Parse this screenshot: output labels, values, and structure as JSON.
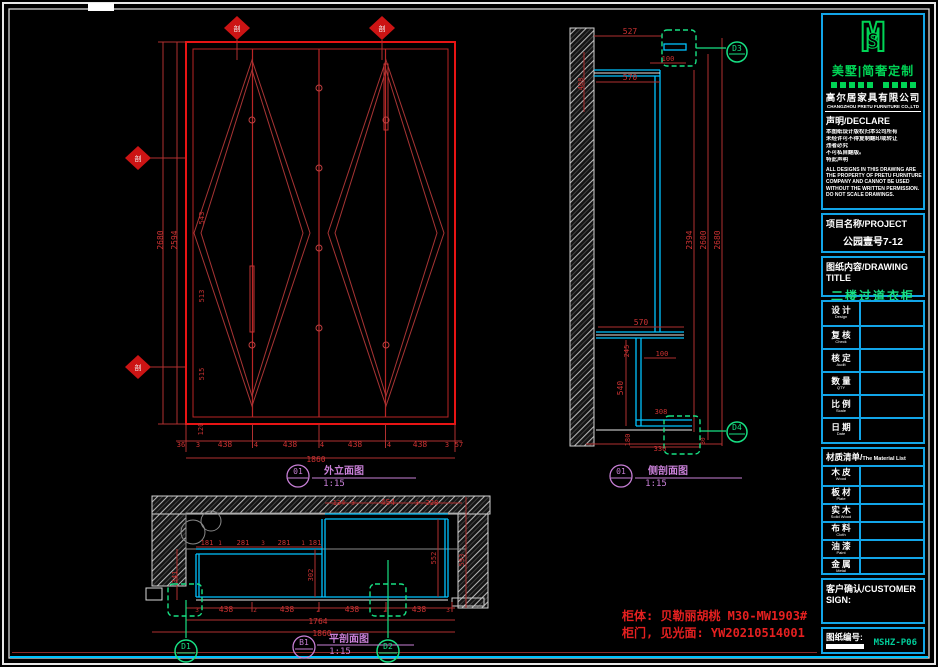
{
  "colors": {
    "dim": "#cd3232",
    "bright": "#e52020",
    "mag": "#c77fd6",
    "grn": "#17e083",
    "wht": "#f2f2f2",
    "cyn": "#00c3ff"
  },
  "title_block": {
    "logo": {
      "m": "M",
      "s": "S",
      "brand": "美墅|简奢定制"
    },
    "company": {
      "zh": "高尔居家具有限公司",
      "en": "CHANGZHOU PRETU FURNITURE CO.,LTD"
    },
    "declare": {
      "header": "声明/DECLARE",
      "zh_lines": [
        "本图纸设计版权归本公司所有",
        "未经许可不得复制翻印或转让",
        "违者必究",
        "不可私自翻版。",
        "特此声明"
      ],
      "en_lines": [
        "ALL DESIGNS IN THIS DRAWING ARE",
        "THE PROPERTY OF PRETU FURNITURE",
        "COMPANY AND CANNOT BE USED",
        "WITHOUT THE WRITTEN PERMISSION.",
        "DO NOT SCALE DRAWINGS."
      ]
    },
    "project": {
      "header": "项目名称/PROJECT",
      "value": "公园壹号7-12"
    },
    "drawing_title": {
      "header": "图纸内容/DRAWING TITLE",
      "value": "二楼过道衣柜"
    },
    "info_table": {
      "rows": [
        {
          "zh": "设  计",
          "en": "Design"
        },
        {
          "zh": "复  核",
          "en": "Check"
        },
        {
          "zh": "核  定",
          "en": "Audit"
        },
        {
          "zh": "数  量",
          "en": "QTY"
        },
        {
          "zh": "比  例",
          "en": "Scale"
        },
        {
          "zh": "日  期",
          "en": "Date"
        }
      ]
    },
    "material_list": {
      "header_zh": "材质清单/",
      "header_en": "The Material List",
      "rows": [
        {
          "zh": "木  皮",
          "en": "Wood"
        },
        {
          "zh": "板  材",
          "en": "Plate"
        },
        {
          "zh": "实  木",
          "en": "Solid Wood"
        },
        {
          "zh": "布  料",
          "en": "Cloth"
        },
        {
          "zh": "油  漆",
          "en": "Paint"
        },
        {
          "zh": "金  属",
          "en": "Metal"
        }
      ]
    },
    "customer": {
      "header": "客户确认/CUSTOMER SIGN:"
    },
    "drawing_no": {
      "label": "图纸编号:",
      "value": "MSHZ-P06"
    }
  },
  "drawing": {
    "texts": [
      {
        "t": "2680",
        "x": 163,
        "y": 240,
        "r": -90,
        "n": "dim-fe-height"
      },
      {
        "t": "2594",
        "x": 177,
        "y": 240,
        "r": -90,
        "n": "dim-fe-height"
      },
      {
        "t": "543",
        "x": 204,
        "y": 218,
        "r": -90,
        "s": 7
      },
      {
        "t": "513",
        "x": 204,
        "y": 296,
        "r": -90,
        "s": 7
      },
      {
        "t": "515",
        "x": 204,
        "y": 374,
        "r": -90,
        "s": 7
      },
      {
        "t": "120",
        "x": 203,
        "y": 429,
        "r": -90,
        "s": 7
      },
      {
        "t": "36",
        "x": 181,
        "y": 447,
        "s": 7
      },
      {
        "t": "3",
        "x": 198,
        "y": 447,
        "s": 7
      },
      {
        "t": "438",
        "x": 225,
        "y": 447
      },
      {
        "t": "4",
        "x": 256,
        "y": 447,
        "s": 7
      },
      {
        "t": "438",
        "x": 290,
        "y": 447
      },
      {
        "t": "4",
        "x": 322,
        "y": 447,
        "s": 7
      },
      {
        "t": "438",
        "x": 355,
        "y": 447
      },
      {
        "t": "4",
        "x": 389,
        "y": 447,
        "s": 7
      },
      {
        "t": "438",
        "x": 420,
        "y": 447
      },
      {
        "t": "3",
        "x": 447,
        "y": 447,
        "s": 7
      },
      {
        "t": "57",
        "x": 459,
        "y": 447,
        "s": 7
      },
      {
        "t": "1860",
        "x": 316,
        "y": 462,
        "n": "dim-fe-total"
      },
      {
        "t": "01",
        "x": 298,
        "y": 474,
        "c": "mag",
        "n": "view-bubble"
      },
      {
        "t": "外立面图",
        "x": 344,
        "y": 474,
        "c": "mag",
        "s": 10,
        "b": 1,
        "n": "view-title",
        "f": 1
      },
      {
        "t": "1:15",
        "x": 334,
        "y": 486,
        "c": "mag",
        "s": 9,
        "n": "view-scale"
      },
      {
        "t": "剖",
        "x": 237,
        "y": 31,
        "c": "wht",
        "s": 7,
        "n": "section-marker-label",
        "f": 1
      },
      {
        "t": "剖",
        "x": 382,
        "y": 31,
        "c": "wht",
        "s": 7,
        "n": "section-marker-label",
        "f": 1
      },
      {
        "t": "剖",
        "x": 138,
        "y": 161,
        "c": "wht",
        "s": 7,
        "n": "section-marker-label",
        "f": 1
      },
      {
        "t": "剖",
        "x": 138,
        "y": 370,
        "c": "wht",
        "s": 7,
        "n": "section-marker-label",
        "f": 1
      },
      {
        "t": "527",
        "x": 630,
        "y": 34
      },
      {
        "t": "100",
        "x": 668,
        "y": 61,
        "s": 7
      },
      {
        "t": "570",
        "x": 630,
        "y": 80
      },
      {
        "t": "408",
        "x": 583,
        "y": 84,
        "r": -90,
        "s": 7
      },
      {
        "t": "2394",
        "x": 692,
        "y": 240,
        "r": -90
      },
      {
        "t": "2600",
        "x": 706,
        "y": 240,
        "r": -90
      },
      {
        "t": "2680",
        "x": 720,
        "y": 240,
        "r": -90
      },
      {
        "t": "570",
        "x": 641,
        "y": 325
      },
      {
        "t": "245",
        "x": 629,
        "y": 351,
        "r": -90,
        "s": 7
      },
      {
        "t": "100",
        "x": 662,
        "y": 356,
        "s": 7
      },
      {
        "t": "540",
        "x": 623,
        "y": 388,
        "r": -90
      },
      {
        "t": "308",
        "x": 661,
        "y": 414,
        "s": 7
      },
      {
        "t": "180",
        "x": 630,
        "y": 440,
        "r": -90,
        "s": 7
      },
      {
        "t": "330",
        "x": 660,
        "y": 451,
        "s": 7
      },
      {
        "t": "30",
        "x": 705,
        "y": 441,
        "r": -90,
        "s": 6
      },
      {
        "t": "D3",
        "x": 737,
        "y": 51,
        "c": "grn",
        "n": "detail-bubble"
      },
      {
        "t": "D4",
        "x": 737,
        "y": 430,
        "c": "grn",
        "n": "detail-bubble"
      },
      {
        "t": "01",
        "x": 621,
        "y": 474,
        "c": "mag",
        "n": "view-bubble"
      },
      {
        "t": "侧剖面图",
        "x": 668,
        "y": 474,
        "c": "mag",
        "s": 10,
        "b": 1,
        "n": "view-title",
        "f": 1
      },
      {
        "t": "1:15",
        "x": 656,
        "y": 486,
        "c": "mag",
        "s": 9,
        "n": "view-scale"
      },
      {
        "t": "134",
        "x": 339,
        "y": 505,
        "s": 7
      },
      {
        "t": "3",
        "x": 353,
        "y": 505,
        "s": 6
      },
      {
        "t": "454",
        "x": 388,
        "y": 505
      },
      {
        "t": "3",
        "x": 417,
        "y": 505,
        "s": 6
      },
      {
        "t": "228",
        "x": 432,
        "y": 505,
        "s": 7
      },
      {
        "t": "181",
        "x": 207,
        "y": 545,
        "s": 7
      },
      {
        "t": "1",
        "x": 220,
        "y": 545,
        "s": 6
      },
      {
        "t": "281",
        "x": 243,
        "y": 545,
        "s": 7
      },
      {
        "t": "3",
        "x": 263,
        "y": 545,
        "s": 6
      },
      {
        "t": "281",
        "x": 284,
        "y": 545,
        "s": 7
      },
      {
        "t": "1",
        "x": 303,
        "y": 545,
        "s": 6
      },
      {
        "t": "181",
        "x": 315,
        "y": 545,
        "s": 7
      },
      {
        "t": "341",
        "x": 177,
        "y": 577,
        "r": -90,
        "s": 7
      },
      {
        "t": "302",
        "x": 313,
        "y": 575,
        "r": -90,
        "s": 7
      },
      {
        "t": "552",
        "x": 436,
        "y": 558,
        "r": -90,
        "s": 7
      },
      {
        "t": "593",
        "x": 464,
        "y": 560,
        "r": -90,
        "s": 7
      },
      {
        "t": "3",
        "x": 197,
        "y": 612,
        "s": 6
      },
      {
        "t": "438",
        "x": 226,
        "y": 612
      },
      {
        "t": "2",
        "x": 255,
        "y": 612,
        "s": 6
      },
      {
        "t": "438",
        "x": 287,
        "y": 612
      },
      {
        "t": "2",
        "x": 318,
        "y": 612,
        "s": 6
      },
      {
        "t": "438",
        "x": 352,
        "y": 612
      },
      {
        "t": "2",
        "x": 385,
        "y": 612,
        "s": 6
      },
      {
        "t": "438",
        "x": 419,
        "y": 612
      },
      {
        "t": "3",
        "x": 448,
        "y": 612,
        "s": 6
      },
      {
        "t": "1764",
        "x": 318,
        "y": 624,
        "n": "dim-pv-total"
      },
      {
        "t": "1860",
        "x": 322,
        "y": 636,
        "n": "dim-pv-total"
      },
      {
        "t": "D1",
        "x": 186,
        "y": 649,
        "c": "grn",
        "n": "detail-bubble"
      },
      {
        "t": "D2",
        "x": 388,
        "y": 649,
        "c": "grn",
        "n": "detail-bubble"
      },
      {
        "t": "B1",
        "x": 304,
        "y": 645,
        "c": "mag",
        "n": "view-bubble"
      },
      {
        "t": "平剖面图",
        "x": 349,
        "y": 642,
        "c": "mag",
        "s": 10,
        "b": 1,
        "n": "view-title",
        "f": 1
      },
      {
        "t": "1:15",
        "x": 340,
        "y": 654,
        "c": "mag",
        "s": 9,
        "n": "view-scale"
      },
      {
        "t": "柜体: 贝勒丽胡桃 M30-MW1903#",
        "x": 622,
        "y": 620,
        "c": "bright",
        "s": 12,
        "b": 1,
        "a": "s",
        "n": "note-cabinet-body",
        "f": 1
      },
      {
        "t": "柜门, 见光面: YW20210514001",
        "x": 622,
        "y": 637,
        "c": "bright",
        "s": 12,
        "b": 1,
        "a": "s",
        "n": "note-cabinet-door",
        "f": 1
      }
    ]
  }
}
